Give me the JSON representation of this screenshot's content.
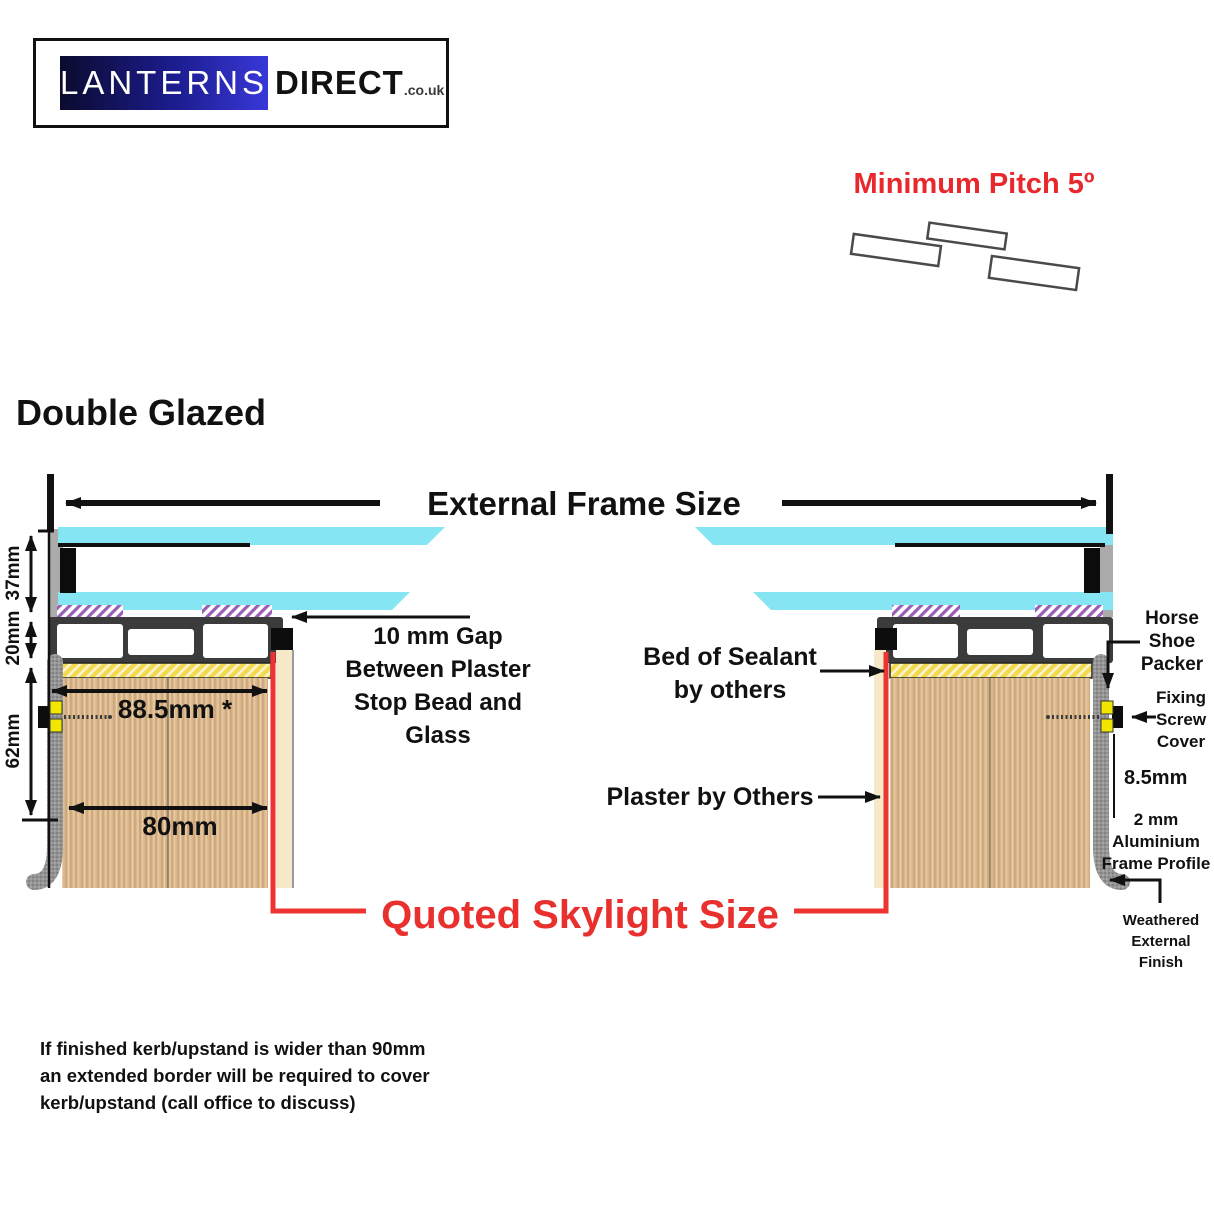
{
  "logo": {
    "primary": "LANTERNS",
    "secondary": "DIRECT",
    "suffix": ".co.uk"
  },
  "pitch": {
    "label": "Minimum Pitch 5º"
  },
  "heading": "Double Glazed",
  "frame": {
    "external_label": "External Frame Size"
  },
  "dims": {
    "glass_height": "37mm",
    "profile_height": "20mm",
    "kerb_height": "62mm",
    "overall_width": "88.5mm *",
    "kerb_width": "80mm",
    "reveal": "8.5mm"
  },
  "notes": {
    "gap": "10 mm Gap\nBetween Plaster\nStop Bead and\nGlass",
    "sealant": "Bed of Sealant\nby others",
    "plaster": "Plaster by Others",
    "quoted": "Quoted Skylight Size",
    "horse_shoe": "Horse\nShoe\nPacker",
    "screw_cover": "Fixing\nScrew\nCover",
    "alu_profile": "2 mm\nAluminium\nFrame Profile",
    "weathered": "Weathered\nExternal\nFinish",
    "footnote": "If finished kerb/upstand is wider than 90mm\nan extended border will be required to cover\nkerb/upstand (call office to discuss)"
  },
  "colors": {
    "accent_red": "#e8282d",
    "glass_cyan": "#85e5f2",
    "sealant_yellow": "#f2d94e",
    "tape_purple": "#9a5fb5",
    "wood_tan": "#dcb88e",
    "frame_dark": "#3b3b3b"
  }
}
